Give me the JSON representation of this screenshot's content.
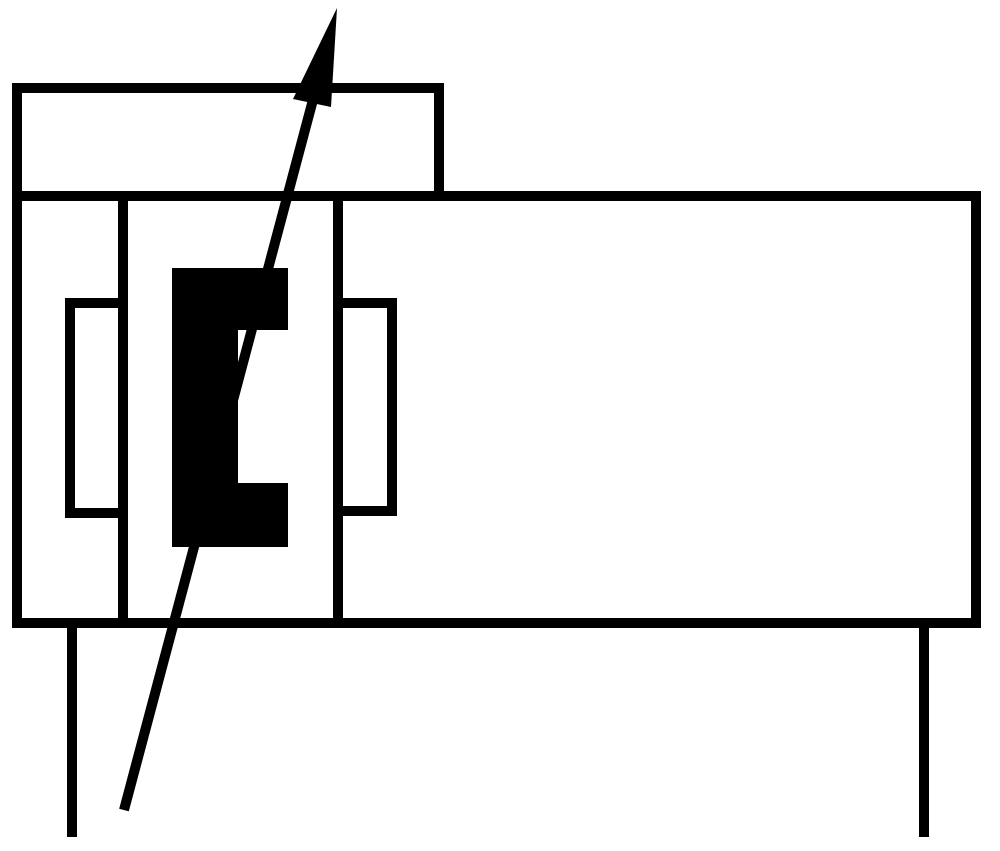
{
  "page": {
    "background_color": "#ffffff"
  },
  "diagram": {
    "name": "pneumatic-cylinder-with-adjustable-cushioning-symbol",
    "canvas_width": 1000,
    "canvas_height": 851,
    "ink_color": "#000000",
    "background_color": "#ffffff",
    "stroke_width": 10,
    "shapes": [
      {
        "name": "end-cap-rect",
        "kind": "rect",
        "x": 17,
        "y": 88,
        "w": 422,
        "h": 108,
        "fill": "none"
      },
      {
        "name": "cylinder-body-rect",
        "kind": "rect",
        "x": 17,
        "y": 196,
        "w": 959,
        "h": 427,
        "fill": "none"
      },
      {
        "name": "piston-left-wall-line",
        "kind": "line",
        "x1": 123,
        "y1": 196,
        "x2": 123,
        "y2": 623
      },
      {
        "name": "piston-right-wall-line",
        "kind": "line",
        "x1": 338,
        "y1": 196,
        "x2": 338,
        "y2": 623
      },
      {
        "name": "left-cushion-rect",
        "kind": "rect",
        "x": 70,
        "y": 303,
        "w": 53,
        "h": 210,
        "fill": "none"
      },
      {
        "name": "right-cushion-rect",
        "kind": "rect",
        "x": 338,
        "y": 303,
        "w": 54,
        "h": 208,
        "fill": "none"
      },
      {
        "name": "cushion-seal-bracket",
        "kind": "polygon",
        "fill": "#000000",
        "points": [
          [
            172,
            268
          ],
          [
            288,
            268
          ],
          [
            288,
            330
          ],
          [
            238,
            330
          ],
          [
            238,
            483
          ],
          [
            288,
            483
          ],
          [
            288,
            547
          ],
          [
            172,
            547
          ]
        ]
      },
      {
        "name": "adjustability-arrow-shaft",
        "kind": "line",
        "x1": 314,
        "y1": 96,
        "x2": 124,
        "y2": 810
      },
      {
        "name": "adjustability-arrow-head",
        "kind": "polygon",
        "fill": "#000000",
        "points": [
          [
            337,
            8
          ],
          [
            331,
            107
          ],
          [
            293,
            99
          ]
        ]
      },
      {
        "name": "left-port-line",
        "kind": "line",
        "x1": 72,
        "y1": 623,
        "x2": 72,
        "y2": 837
      },
      {
        "name": "right-port-line",
        "kind": "line",
        "x1": 924,
        "y1": 623,
        "x2": 924,
        "y2": 837
      }
    ]
  }
}
